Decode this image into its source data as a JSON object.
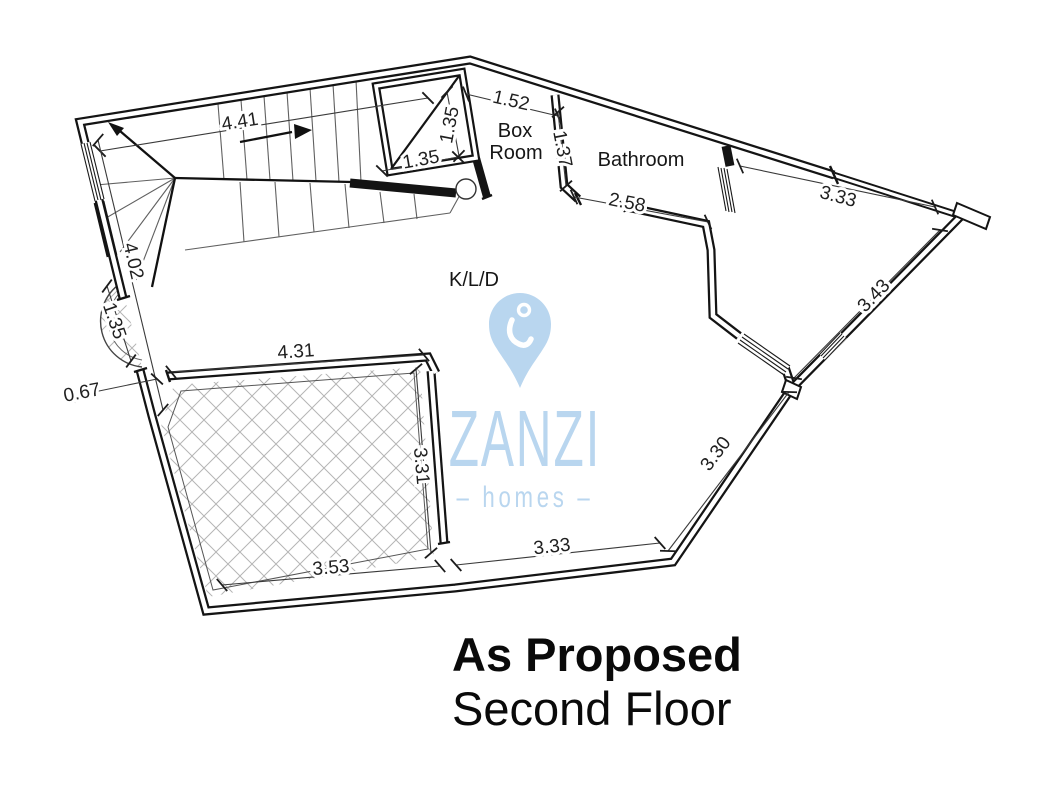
{
  "plan": {
    "rooms": [
      {
        "text": "Box",
        "x": 515,
        "y": 131
      },
      {
        "text": "Room",
        "x": 516,
        "y": 153
      },
      {
        "text": "Bathroom",
        "x": 641,
        "y": 160
      },
      {
        "text": "K/L/D",
        "x": 474,
        "y": 280
      }
    ],
    "dimensions": [
      {
        "v": "4.41",
        "x1": 100,
        "y1": 151,
        "x2": 428,
        "y2": 98,
        "lx": 240,
        "ly": 122,
        "rot": -9
      },
      {
        "v": "1.35",
        "x1": 447,
        "y1": 92,
        "x2": 459,
        "y2": 156,
        "lx": 450,
        "ly": 125,
        "rot": -79
      },
      {
        "v": "1.35",
        "x1": 382,
        "y1": 171,
        "x2": 458,
        "y2": 157,
        "lx": 421,
        "ly": 160,
        "rot": -10
      },
      {
        "v": "1.52",
        "x1": 466,
        "y1": 94,
        "x2": 558,
        "y2": 116,
        "lx": 511,
        "ly": 101,
        "rot": 13
      },
      {
        "v": "1.37",
        "x1": 558,
        "y1": 112,
        "x2": 566,
        "y2": 186,
        "lx": 562,
        "ly": 149,
        "rot": 79
      },
      {
        "v": "2.58",
        "x1": 574,
        "y1": 197,
        "x2": 708,
        "y2": 222,
        "lx": 627,
        "ly": 203,
        "rot": 11
      },
      {
        "v": "3.33",
        "x1": 740,
        "y1": 166,
        "x2": 935,
        "y2": 207,
        "lx": 838,
        "ly": 197,
        "rot": 15
      },
      {
        "v": "3.43",
        "x1": 940,
        "y1": 230,
        "x2": 794,
        "y2": 378,
        "lx": 874,
        "ly": 296,
        "rot": -46
      },
      {
        "v": "4.02",
        "x1": 98,
        "y1": 140,
        "x2": 163,
        "y2": 410,
        "lx": 133,
        "ly": 261,
        "rot": 77
      },
      {
        "v": "1.35",
        "x1": 107,
        "y1": 286,
        "x2": 131,
        "y2": 361,
        "lx": 114,
        "ly": 321,
        "rot": 71
      },
      {
        "v": "0.67",
        "x1": 70,
        "y1": 397,
        "x2": 157,
        "y2": 379,
        "lx": 82,
        "ly": 393,
        "rot": -11
      },
      {
        "v": "4.31",
        "x1": 171,
        "y1": 372,
        "x2": 424,
        "y2": 355,
        "lx": 296,
        "ly": 352,
        "rot": -4
      },
      {
        "v": "3.31",
        "x1": 416,
        "y1": 369,
        "x2": 431,
        "y2": 553,
        "lx": 421,
        "ly": 466,
        "rot": 85
      },
      {
        "v": "3.53",
        "x1": 222,
        "y1": 585,
        "x2": 440,
        "y2": 566,
        "lx": 331,
        "ly": 568,
        "rot": -5
      },
      {
        "v": "3.33",
        "x1": 456,
        "y1": 565,
        "x2": 660,
        "y2": 543,
        "lx": 552,
        "ly": 547,
        "rot": -6
      },
      {
        "v": "3.30",
        "x1": 668,
        "y1": 551,
        "x2": 789,
        "y2": 392,
        "lx": 716,
        "ly": 454,
        "rot": -53
      }
    ]
  },
  "logo": {
    "brand": "ZANZI",
    "tagline": "– homes –",
    "color": "#b9d6ef"
  },
  "title": {
    "line1": "As Proposed",
    "line2": "Second Floor"
  }
}
